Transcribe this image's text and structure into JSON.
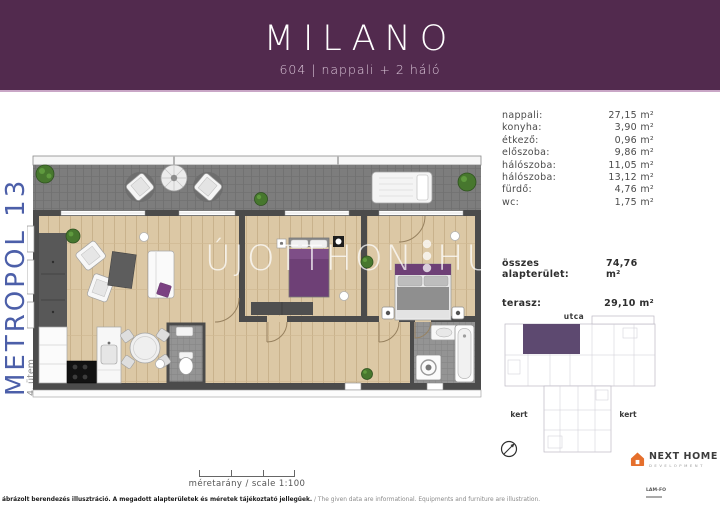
{
  "header": {
    "title": "MILANO",
    "subtitle": "604 | nappali + 2 háló",
    "bg_color": "#522a4e",
    "divider_color": "#c9a6c6"
  },
  "project": {
    "name": "METROPOL 13",
    "phase": "4. ütem",
    "name_color": "#4c5fa9"
  },
  "rooms": {
    "rows": [
      {
        "label": "nappali:",
        "value": "27,15 m²"
      },
      {
        "label": "konyha:",
        "value": "3,90 m²"
      },
      {
        "label": "étkező:",
        "value": "0,96 m²"
      },
      {
        "label": "előszoba:",
        "value": "9,86 m²"
      },
      {
        "label": "hálószoba:",
        "value": "11,05 m²"
      },
      {
        "label": "hálószoba:",
        "value": "13,12 m²"
      },
      {
        "label": "fürdő:",
        "value": "4,76 m²"
      },
      {
        "label": "wc:",
        "value": "1,75 m²"
      }
    ]
  },
  "totals": {
    "area_label": "összes alapterület:",
    "area_value": "74,76 m²",
    "terrace_label": "terasz:",
    "terrace_value": "29,10 m²"
  },
  "floorplan": {
    "watermark_left": "ÚJOTTHON",
    "watermark_right": "HU",
    "wall_color": "#4b4b4b",
    "floor_color": "#dcc8a5",
    "terrace_color": "#7d7d7d",
    "accent_purple": "#6e4076"
  },
  "scale": {
    "label": "méretarány / scale 1:100"
  },
  "siteplan": {
    "street": "utca",
    "garden_left": "kert",
    "garden_right": "kert",
    "unit_color": "#5d4970"
  },
  "footer": {
    "disclaimer_bold": "ábrázolt berendezés illusztráció. A megadott alapterületek és méretek tájékoztató jellegűek.",
    "disclaimer_regular": " / The given data are informational. Equipments and furniture are illustration.",
    "brand": "NEXT HOME",
    "brand_sub": "DEVELOPMENT",
    "brand_color": "#e56f2c",
    "partner": "LAM-FO"
  }
}
